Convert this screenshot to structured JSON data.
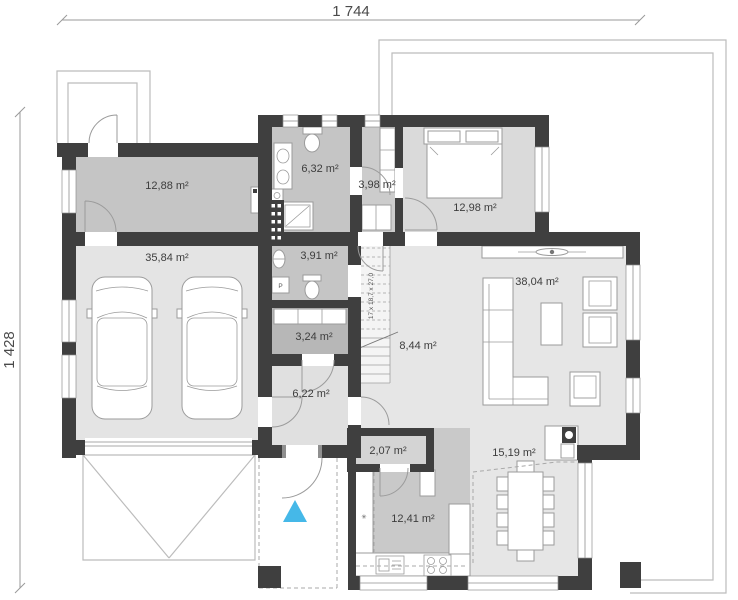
{
  "dimensions": {
    "width_label": "1 744",
    "height_label": "1 428"
  },
  "rooms": [
    {
      "id": "utility",
      "area": "12,88 m²"
    },
    {
      "id": "bathroom",
      "area": "6,32 m²"
    },
    {
      "id": "wardrobe",
      "area": "3,98 m²"
    },
    {
      "id": "bedroom",
      "area": "12,98 m²"
    },
    {
      "id": "garage",
      "area": "35,84 m²"
    },
    {
      "id": "wc",
      "area": "3,91 m²"
    },
    {
      "id": "living",
      "area": "38,04 m²"
    },
    {
      "id": "storage",
      "area": "3,24 m²"
    },
    {
      "id": "hall",
      "area": "8,44 m²"
    },
    {
      "id": "vestibule",
      "area": "6,22 m²"
    },
    {
      "id": "pantry",
      "area": "2,07 m²"
    },
    {
      "id": "dining",
      "area": "15,19 m²"
    },
    {
      "id": "kitchen",
      "area": "12,41 m²"
    }
  ],
  "stairs": {
    "label": "17 x 18,7 x 27,0"
  },
  "entrance": {
    "marker_color": "#45b8e8"
  },
  "colors": {
    "wall": "#3f3f3f"
  }
}
